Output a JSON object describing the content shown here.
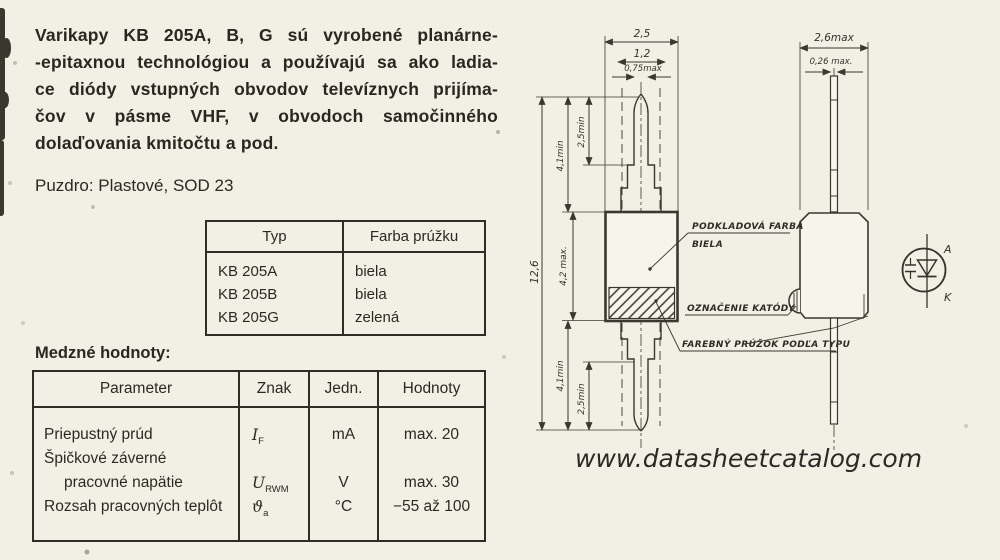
{
  "colors": {
    "paper": "#f2f0e4",
    "ink": "#262520",
    "line": "#3a382f"
  },
  "intro": {
    "lines": [
      "Varikapy KB 205A, B, G sú vyrobené planárne-",
      "-epitaxnou technológiou a používajú sa ako ladia-",
      "ce diódy vstupných obvodov televíznych prijíma-",
      "čov v pásme VHF, v obvodoch samočinného",
      "dolaďovania kmitočtu a pod."
    ]
  },
  "package_line": "Puzdro: Plastové, SOD 23",
  "type_table": {
    "headers": [
      "Typ",
      "Farba prúžku"
    ],
    "rows": [
      [
        "KB 205A",
        "biela"
      ],
      [
        "KB 205B",
        "biela"
      ],
      [
        "KB 205G",
        "zelená"
      ]
    ]
  },
  "limits": {
    "title": "Medzné hodnoty:",
    "headers": [
      "Parameter",
      "Znak",
      "Jedn.",
      "Hodnoty"
    ],
    "param_lines": [
      "Priepustný prúd",
      "Špičkové záverné",
      "pracovné napätie",
      "Rozsah pracovných teplôt"
    ],
    "znak": [
      {
        "b": "I",
        "s": "F"
      },
      {
        "b": "",
        "s": ""
      },
      {
        "b": "U",
        "s": "RWM"
      },
      {
        "b": "ϑ",
        "s": "a"
      }
    ],
    "jedn": [
      "mA",
      "",
      "V",
      "°C"
    ],
    "hodnoty": [
      "max. 20",
      "",
      "max. 30",
      "−55 až 100"
    ]
  },
  "drawing": {
    "dims": {
      "front_width": "2,5",
      "front_width_mid": "1,2",
      "front_lead_w": "0,75max",
      "total_h": "12,6",
      "lead_top": "4,1min",
      "lead_top_inner": "2,5min",
      "body_h": "4,2 max.",
      "lead_bot": "4,1min",
      "lead_bot_inner": "2,5min",
      "side_width": "2,6max",
      "side_lead_w": "0,26 max."
    },
    "labels": {
      "base_color_1": "PODKLADOVÁ FARBA",
      "base_color_2": "BIELA",
      "cathode_mark": "OZNAČENIE KATÓDY",
      "stripe": "FAREBNÝ PRÚŽOK PODĽA TYPU"
    },
    "symbol": {
      "anode": "A",
      "cathode": "K"
    }
  },
  "watermark": "www.datasheetcatalog.com"
}
